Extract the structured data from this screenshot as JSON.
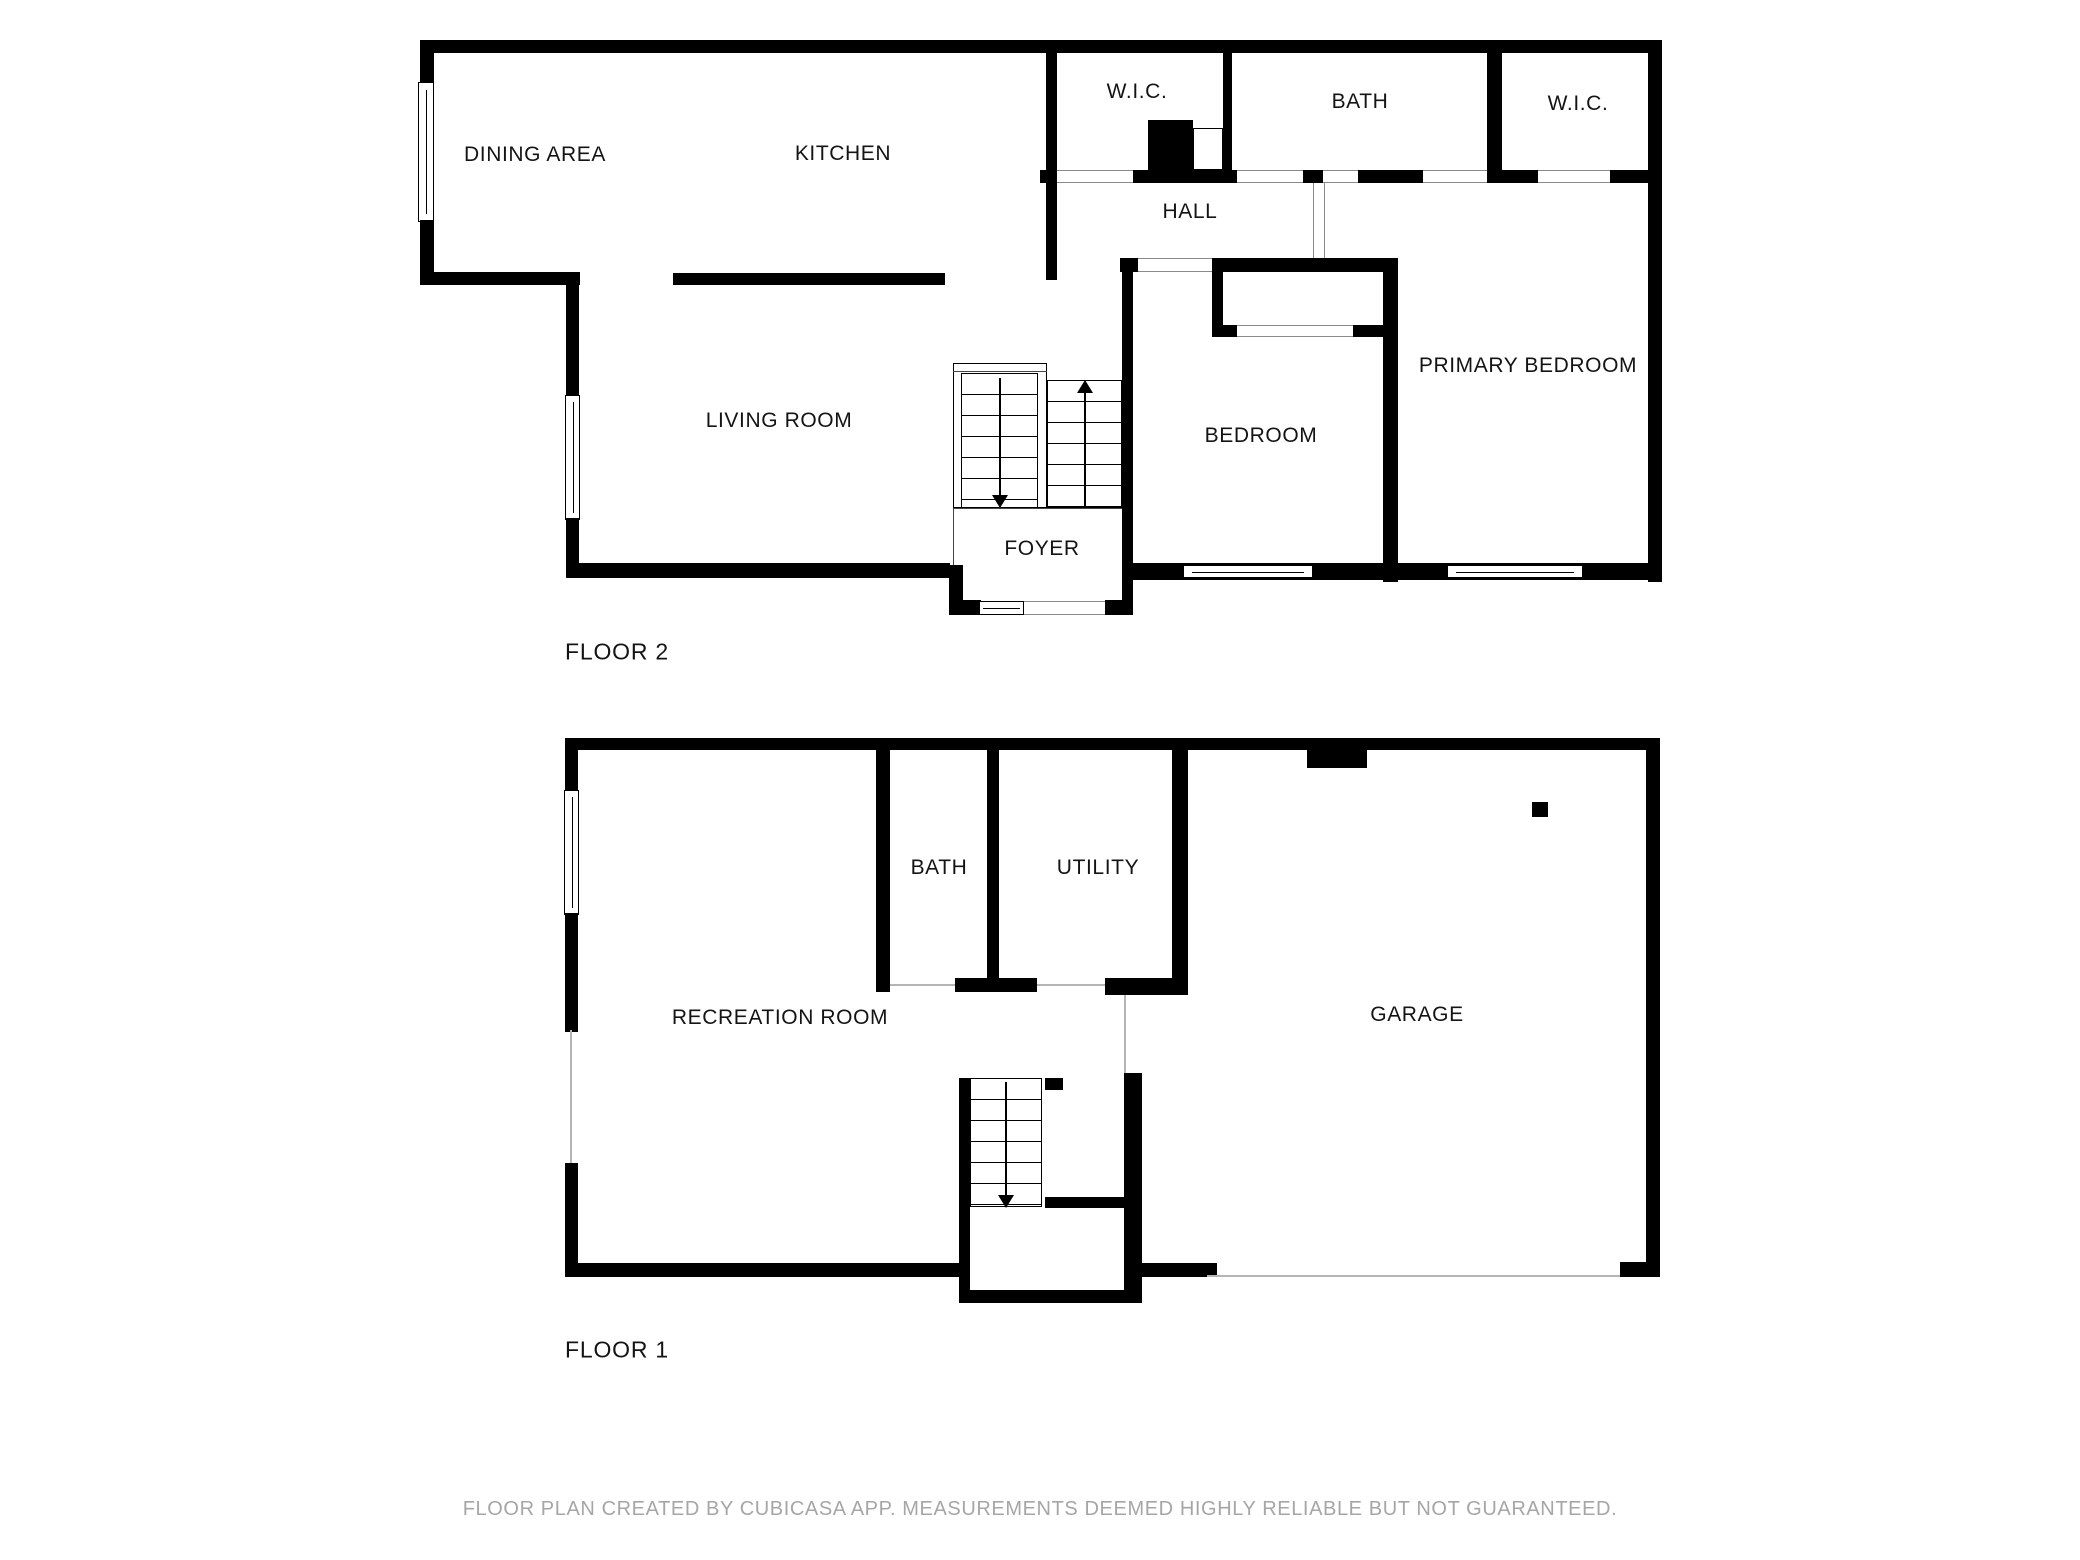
{
  "floor2": {
    "title": "FLOOR 2",
    "rooms": [
      {
        "label": "DINING AREA"
      },
      {
        "label": "KITCHEN"
      },
      {
        "label": "W.I.C."
      },
      {
        "label": "BATH"
      },
      {
        "label": "W.I.C."
      },
      {
        "label": "HALL"
      },
      {
        "label": "LIVING ROOM"
      },
      {
        "label": "BEDROOM"
      },
      {
        "label": "PRIMARY BEDROOM"
      },
      {
        "label": "FOYER"
      }
    ]
  },
  "floor1": {
    "title": "FLOOR 1",
    "rooms": [
      {
        "label": "BATH"
      },
      {
        "label": "UTILITY"
      },
      {
        "label": "RECREATION ROOM"
      },
      {
        "label": "GARAGE"
      }
    ]
  },
  "footer": {
    "text": "FLOOR PLAN CREATED BY CUBICASA APP. MEASUREMENTS DEEMED HIGHLY RELIABLE BUT NOT GUARANTEED."
  },
  "colors": {
    "wall": "#000000",
    "background": "#ffffff",
    "footer_text": "#a6a6a6",
    "opening_line": "#8a8a8a"
  }
}
